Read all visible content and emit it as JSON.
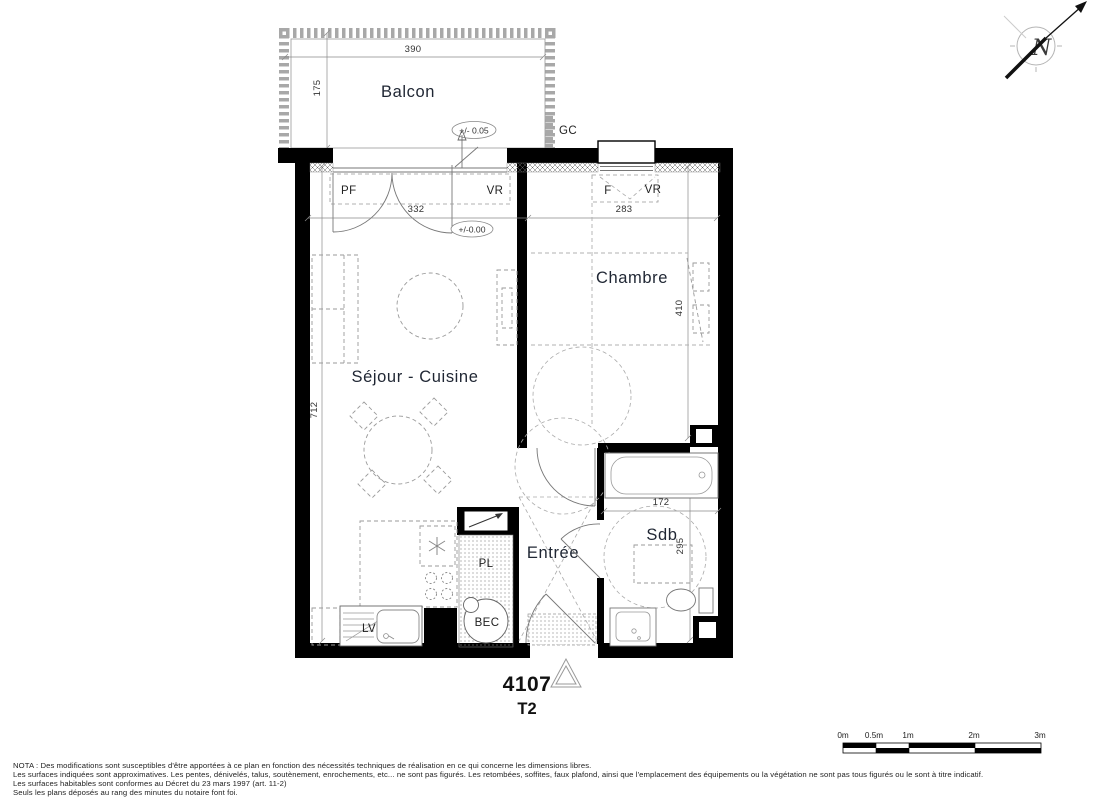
{
  "rooms": {
    "balcony": {
      "name": "Balcon",
      "width": "390",
      "depth": "175",
      "level": "+/- 0.05"
    },
    "living": {
      "name": "Séjour - Cuisine",
      "width": "332",
      "height": "712",
      "level": "+/-0.00"
    },
    "bedroom": {
      "name": "Chambre",
      "width": "283",
      "height": "410"
    },
    "bathroom": {
      "name": "Sdb",
      "width": "172",
      "height": "295"
    },
    "entry": {
      "name": "Entrée"
    }
  },
  "openings": {
    "french_window": "PF",
    "living_shutter": "VR",
    "bedroom_window": "F",
    "bedroom_shutter": "VR"
  },
  "fixtures": {
    "closet": "PL",
    "water_heater": "BEC",
    "dishwasher": "LV",
    "duct": "GC"
  },
  "unit": {
    "number": "4107",
    "type": "T2"
  },
  "compass": {
    "north": "N"
  },
  "scale_bar": {
    "labels": [
      "0m",
      "0.5m",
      "1m",
      "2m",
      "3m"
    ]
  },
  "colors": {
    "wall": "#000000",
    "furniture_line": "#9a9a9a",
    "text": "#1f2633"
  },
  "notes": {
    "line1": "NOTA : Des modifications sont susceptibles d'être apportées à ce plan en fonction des nécessités techniques de réalisation en ce qui concerne les dimensions libres.",
    "line2": "Les surfaces indiquées sont approximatives. Les pentes, dénivelés, talus, soutènement, enrochements, etc... ne sont pas figurés. Les retombées, soffites, faux plafond, ainsi que l'emplacement des équipements ou la végétation ne sont pas tous figurés ou le sont à titre indicatif.",
    "line3": "Les surfaces habitables sont conformes au Décret du 23 mars 1997 (art. 11-2)",
    "line4": "Seuls les plans déposés au rang des minutes du notaire font foi."
  }
}
